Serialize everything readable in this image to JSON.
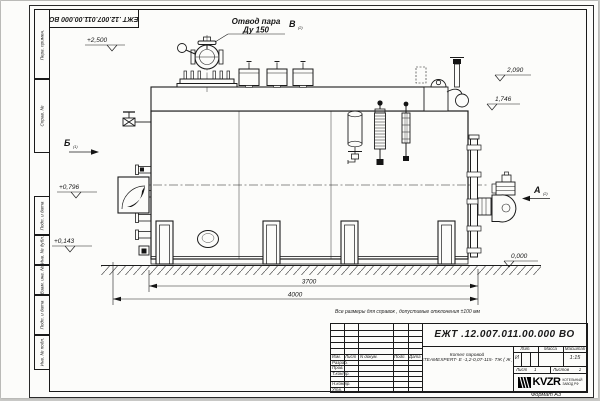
{
  "sheet": {
    "stamp_number": "ЕЖТ .12.007.011.00.000  ВО",
    "note": "Все размеры для справок , допустимые отклонения  ±100  мм",
    "format_label": "Формат  А3"
  },
  "frame_labels": [
    "Перв. примен.",
    "Справ. №",
    "Подп. и дата",
    "Инв. № дубл.",
    "Взам. инв. №",
    "Подп. и дата",
    "Инв. № подл."
  ],
  "labels": {
    "steam1": "Отвод пара",
    "steam2": "Ду 150",
    "view_v": "В",
    "view_v_sub": "(2)",
    "view_b": "Б",
    "view_b_sub": "(1)",
    "view_a": "А",
    "view_a_sub": "(2)",
    "e2500": "+2,500",
    "e2090": "2,090",
    "e1746": "1,746",
    "e0796": "+0,796",
    "e0143": "+0,143",
    "e0000": "0,000",
    "d3700": "3700",
    "d4000": "4000"
  },
  "title_block": {
    "doc_number": "ЕЖТ .12.007.011.00.000  ВО",
    "product_name_1": "Котел паровой",
    "product_name_2": "STEAMEXPERT- Е -1,2-0,07-115- ТЖ ( Ж )",
    "col_izm": "Изм.",
    "col_list": "Лист",
    "col_ndokum": "N докум.",
    "col_podp": "Подп.",
    "col_data": "Дата",
    "rows": [
      "Разраб.",
      "Пров.",
      "Т.контр.",
      "",
      "Н.контр.",
      "Утв."
    ],
    "lit_label": "Лит.",
    "lit_value": "И",
    "massa_label": "Масса",
    "masshtab_label": "Масштаб",
    "scale_value": "1:15",
    "sheet_label": "Лист",
    "sheet_value": "1",
    "sheets_label": "Листов",
    "sheets_value": "2",
    "company_name": "KVZR",
    "company_line1": "КОТЕЛЬНЫЙ",
    "company_line2": "ЗАВОД РФ"
  }
}
